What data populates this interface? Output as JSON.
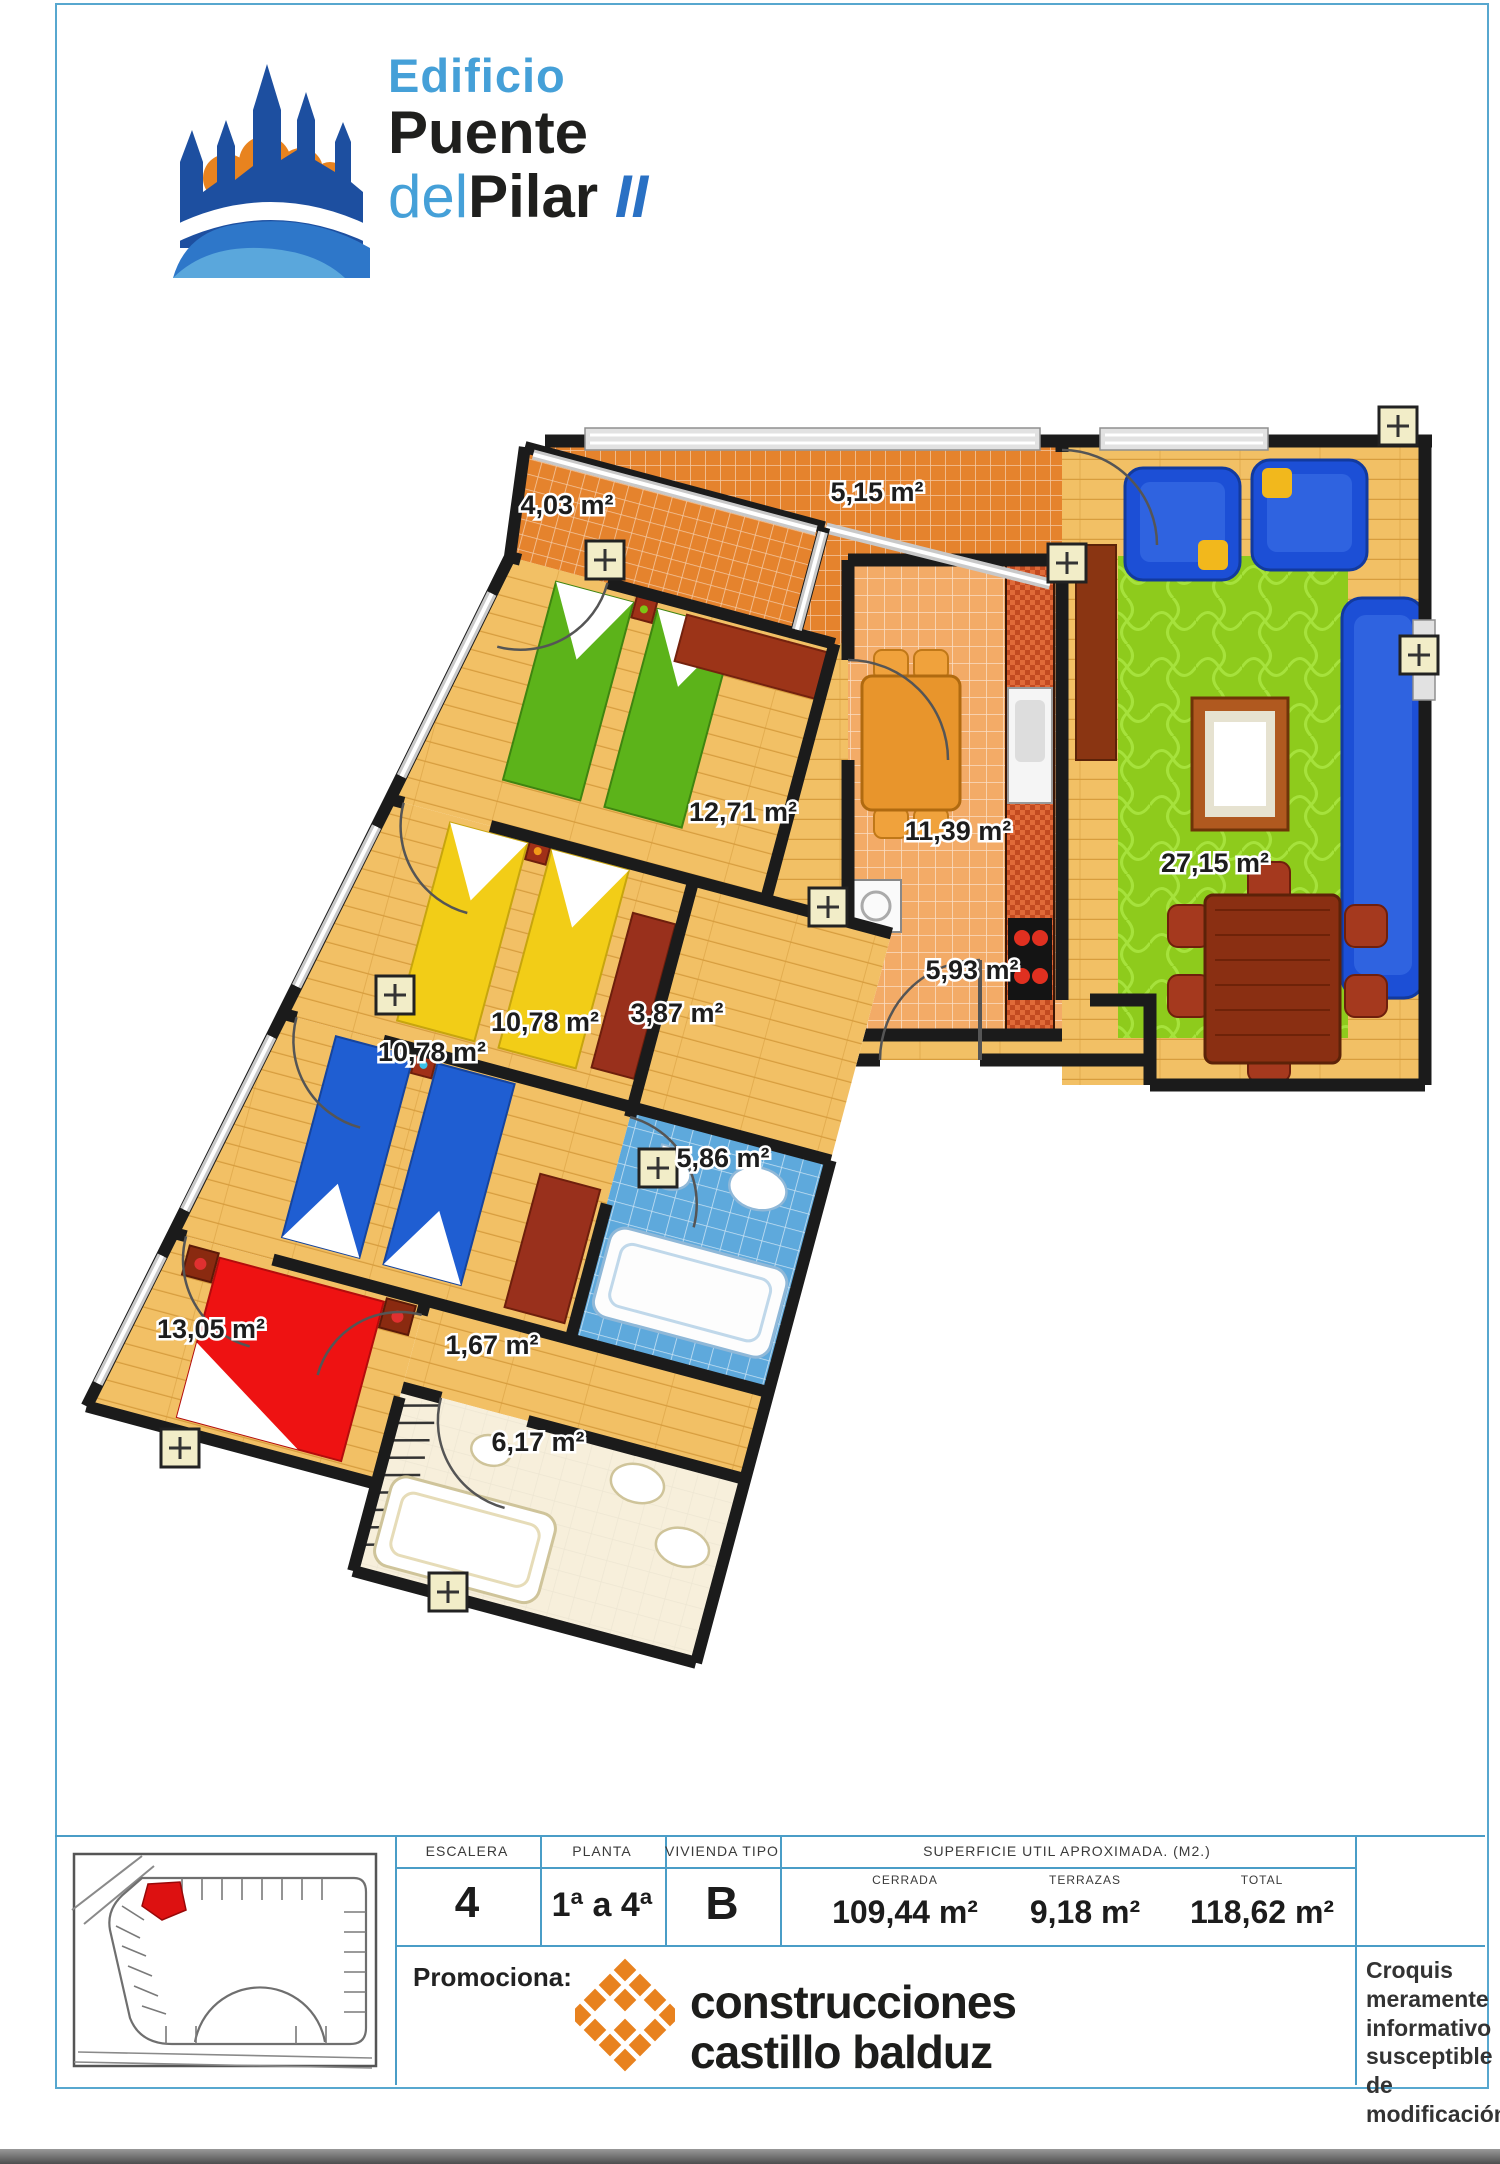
{
  "logo": {
    "line1": "Edificio",
    "line2": "Puente",
    "line3_prefix": "del",
    "line3_main": "Pilar",
    "line3_suffix": "II",
    "accent_blue": "#45a0d8",
    "dark": "#1f1f1d",
    "brand_blue": "#1d4fa0",
    "brand_orange": "#e8831f"
  },
  "plan": {
    "rooms": [
      {
        "id": "terraza-pequena",
        "area": "4,03 m²"
      },
      {
        "id": "terraza-grande",
        "area": "5,15 m²"
      },
      {
        "id": "dormitorio-verde",
        "area": "12,71 m²"
      },
      {
        "id": "cocina",
        "area": "11,39 m²"
      },
      {
        "id": "salon-comedor",
        "area": "27,15 m²"
      },
      {
        "id": "vestibulo",
        "area": "5,93 m²"
      },
      {
        "id": "distribuidor",
        "area": "3,87 m²"
      },
      {
        "id": "dormitorio-amarillo",
        "area": "10,78 m²"
      },
      {
        "id": "dormitorio-azul",
        "area": "10,78 m²"
      },
      {
        "id": "bano-azul",
        "area": "5,86 m²"
      },
      {
        "id": "dormitorio-principal",
        "area": "13,05 m²"
      },
      {
        "id": "armario",
        "area": "1,67 m²"
      },
      {
        "id": "bano-grande",
        "area": "6,17 m²"
      }
    ]
  },
  "table": {
    "headers": {
      "escalera": "ESCALERA",
      "planta": "PLANTA",
      "vivienda": "VIVIENDA TIPO",
      "superficie": "SUPERFICIE UTIL APROXIMADA. (M2.)"
    },
    "values": {
      "escalera": "4",
      "planta": "1ª a 4ª",
      "vivienda": "B"
    },
    "superficie": [
      {
        "label": "CERRADA",
        "value": "109,44 m²"
      },
      {
        "label": "TERRAZAS",
        "value": "9,18 m²"
      },
      {
        "label": "TOTAL",
        "value": "118,62 m²"
      }
    ]
  },
  "footer": {
    "promo_label": "Promociona:",
    "company_line1": "construcciones",
    "company_line2": "castillo balduz",
    "disclaimer": "Croquis meramente informativo susceptible de modificación",
    "border_blue": "#57a7cf"
  }
}
